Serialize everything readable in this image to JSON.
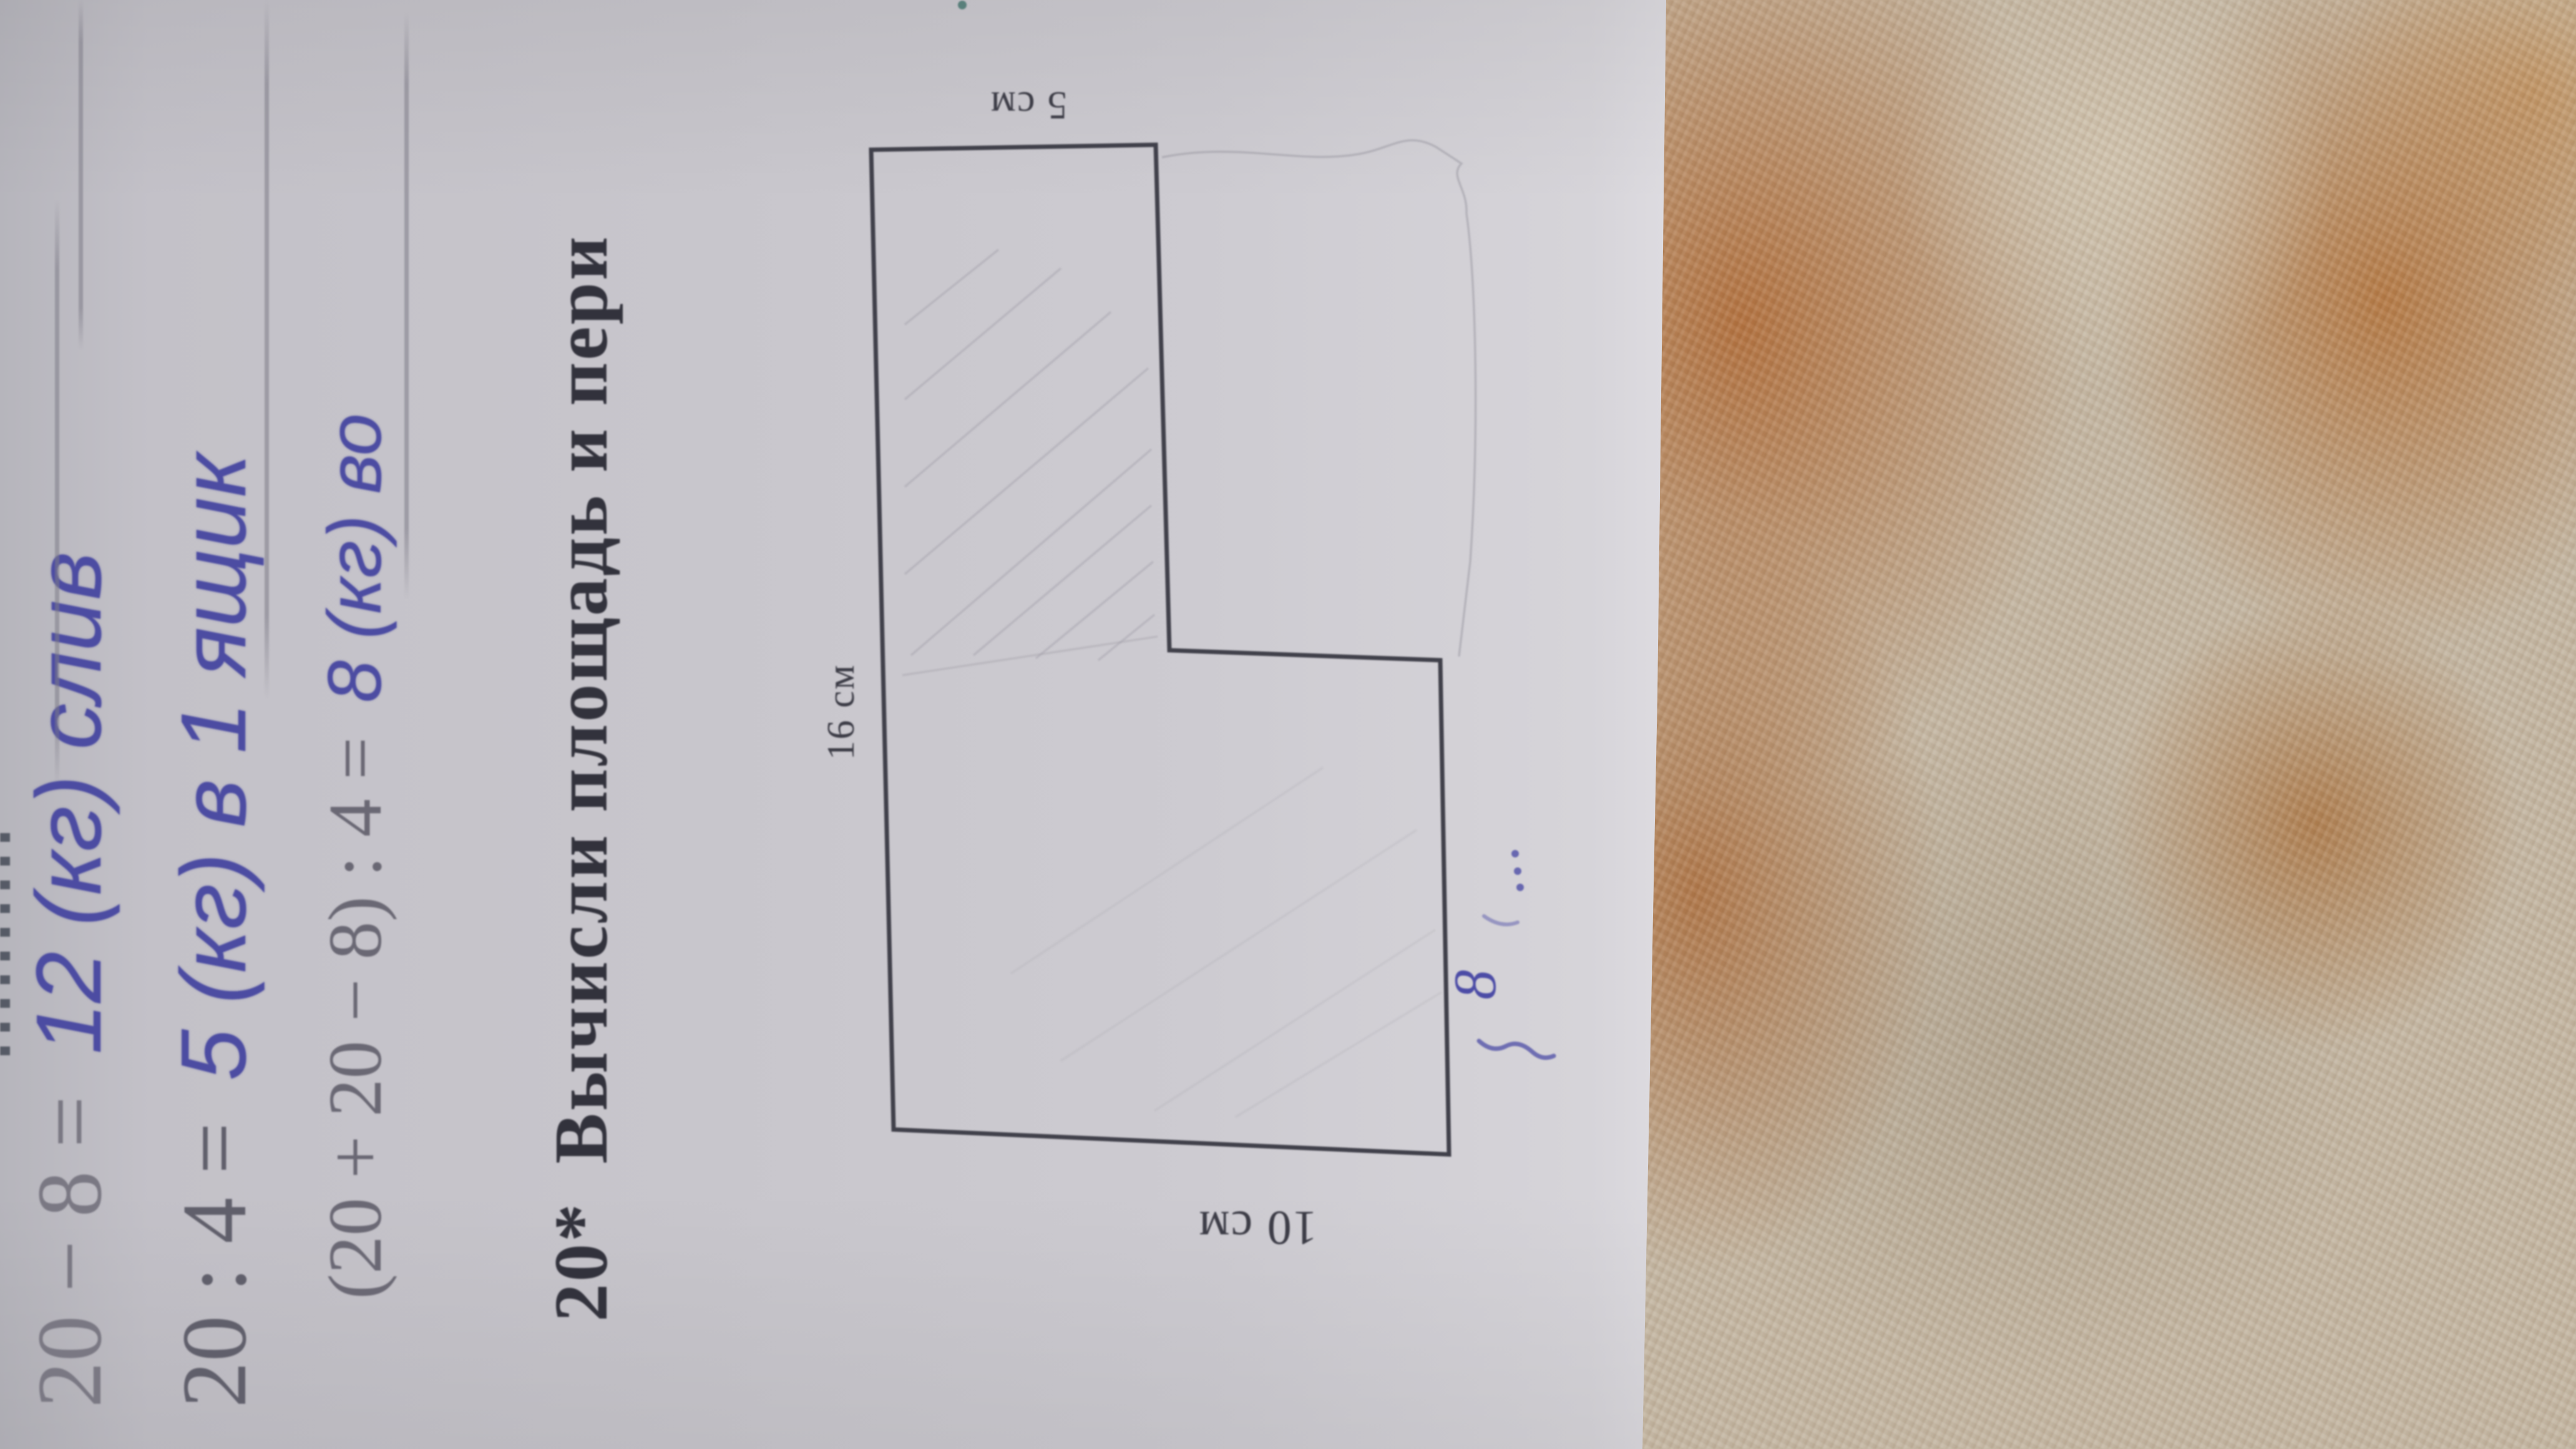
{
  "problem": {
    "number": "20*",
    "title": "Вычисли площадь и пери"
  },
  "handwriting": {
    "line1_printed": "20 − 8 =",
    "line1_answer": "12 (кг) слив",
    "line2_printed": "20 : 4 =",
    "line2_answer": "5 (кг) в 1 ящик",
    "line3_printed": "(20 + 20 − 8) : 4 =",
    "line3_answer": "8 (кг) во"
  },
  "figure": {
    "top_label": "5 см",
    "left_label": "16 см",
    "bottom_label": "10 см",
    "annotation_value": "8",
    "annotation_dots": "…"
  },
  "colors": {
    "ink_blue": "#4c4ca2",
    "print_dark": "#32323c",
    "pencil_gray": "#9d9ba4",
    "paper_gray": "#c8c6cc",
    "carpet_orange": "#b5713c",
    "carpet_cream": "#c4b7a3"
  }
}
